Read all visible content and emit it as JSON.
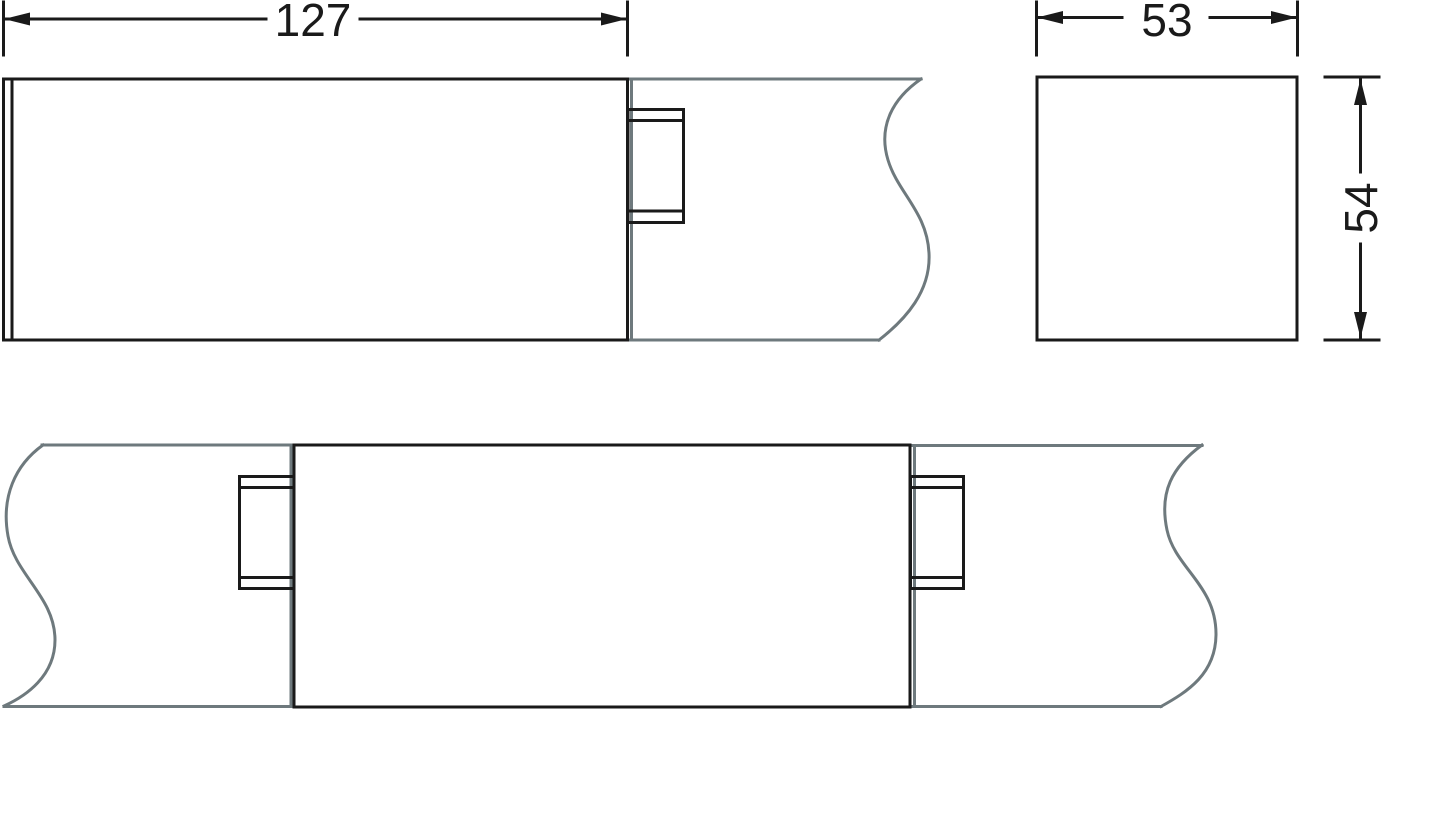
{
  "drawing": {
    "background": "#ffffff",
    "line_colors": {
      "part": "#1a1a1a",
      "channel": "#6e797d"
    },
    "dimensions": {
      "length": {
        "label": "127",
        "value": 127,
        "orientation": "horizontal"
      },
      "width": {
        "label": "53",
        "value": 53,
        "orientation": "horizontal"
      },
      "height": {
        "label": "54",
        "value": 54,
        "orientation": "vertical"
      }
    }
  }
}
